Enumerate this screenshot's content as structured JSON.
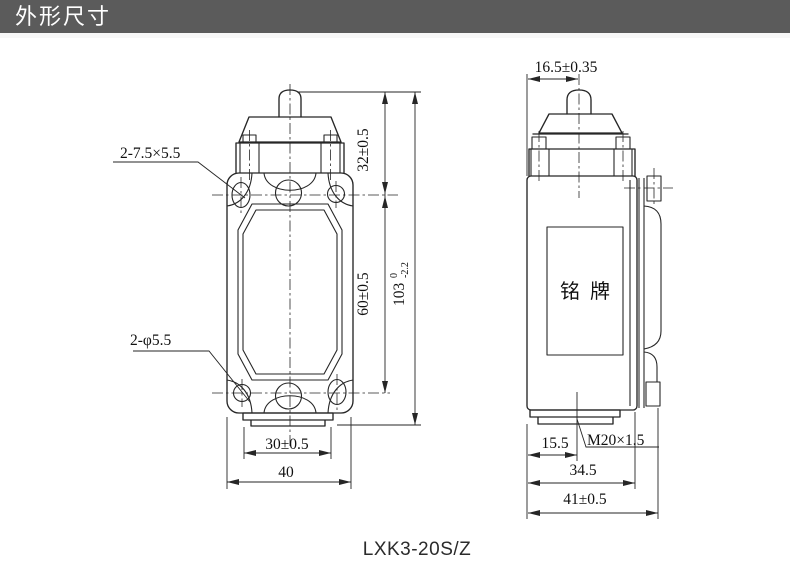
{
  "header": {
    "title": "外形尺寸"
  },
  "caption": "LXK3-20S/Z",
  "front_view": {
    "labels": {
      "slot_holes": "2-7.5×5.5",
      "round_holes": "2-φ5.5"
    },
    "dims": {
      "top_to_holes": "32±0.5",
      "hole_pitch": "60±0.5",
      "overall_height": "103",
      "overall_height_tol_upper": "0",
      "overall_height_tol_lower": "-2.2",
      "base_width": "30±0.5",
      "overall_width": "40"
    }
  },
  "side_view": {
    "nameplate_label": "铭牌",
    "dims": {
      "plunger_center": "16.5±0.35",
      "conduit_center": "15.5",
      "conduit_thread": "M20×1.5",
      "body_depth": "34.5",
      "overall_depth": "41±0.5"
    }
  },
  "colors": {
    "header_bg": "#5b5b5b",
    "line": "#262626"
  }
}
